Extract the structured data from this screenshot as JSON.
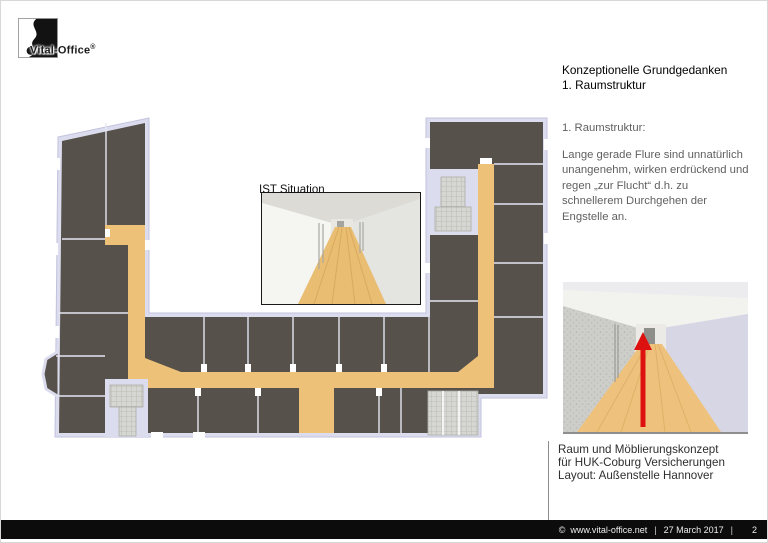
{
  "slide": {
    "logo": {
      "brand": "Vital-Office",
      "registered": "®"
    },
    "heading": {
      "line1": "Konzeptionelle Grundgedanken",
      "line2": "1. Raumstruktur"
    },
    "concept": {
      "subtitle": "1. Raumstruktur:",
      "paragraph": "Lange gerade Flure sind unnatürlich\nunangenehm, wirken erdrückend und\nregen „zur Flucht“ d.h. zu\nschnellerem Durchgehen der\nEngstelle an."
    },
    "floor_plan": {
      "inset_label": "IST Situation"
    },
    "caption": "Raum und Möblierungskonzept\nfür HUK-Coburg Versicherungen\nLayout: Außenstelle Hannover",
    "footer": {
      "copyright_symbol": "©",
      "website": "www.vital-office.net",
      "separator": "|",
      "date": "27 March 2017",
      "page": "2"
    },
    "colors": {
      "rooms": "#57514b",
      "corridor": "#edc278",
      "walls": "#dcdcef",
      "stairs": "#d6d6d2",
      "arrow": "#de1111",
      "footer_bg": "#0c0c0c"
    }
  }
}
